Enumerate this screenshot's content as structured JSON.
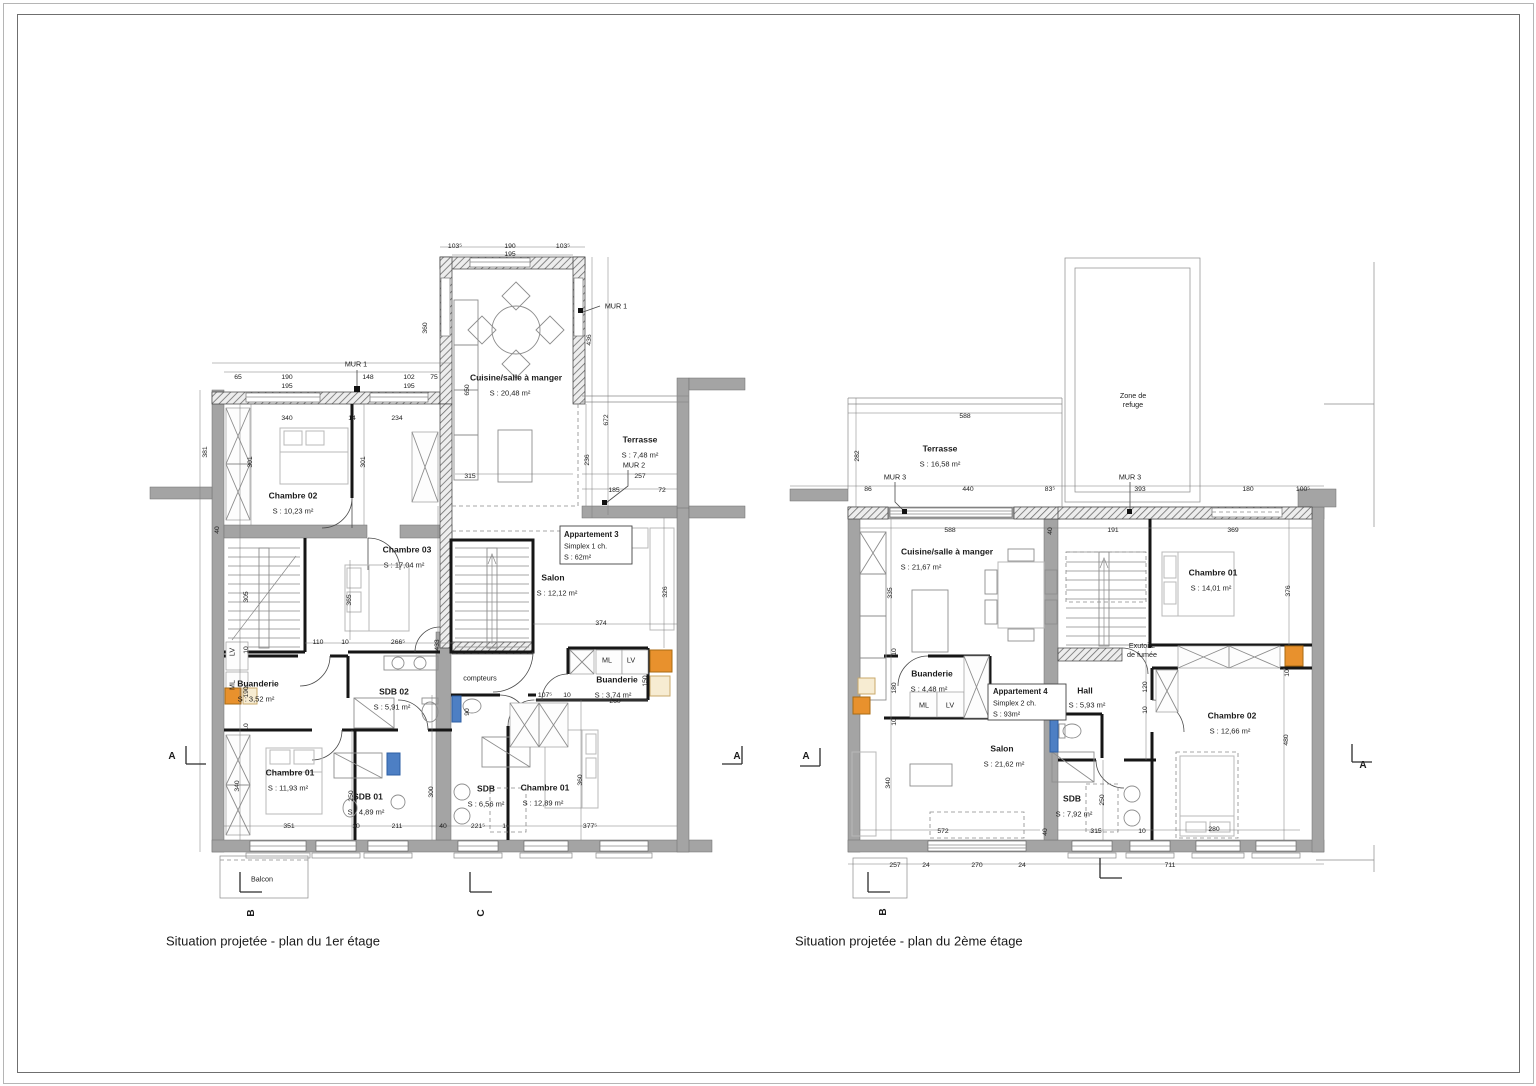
{
  "captions": {
    "plan1": "Situation projetée - plan du 1er étage",
    "plan2": "Situation projetée - plan du 2ème étage"
  },
  "colors": {
    "wall_gray": "#a4a4a4",
    "partition_black": "#161616",
    "accent_orange": "#e8912d",
    "accent_blue": "#4d7fc4",
    "accent_beige": "#f7ecd2"
  },
  "plan1": {
    "labels": [
      {
        "t": "Cuisine/salle à manger",
        "x": 516,
        "y": 378,
        "c": "rm"
      },
      {
        "t": "S : 20,48 m²",
        "x": 510,
        "y": 393,
        "c": "ar"
      },
      {
        "t": "Terrasse",
        "x": 640,
        "y": 440,
        "c": "rm"
      },
      {
        "t": "S : 7,48 m²",
        "x": 640,
        "y": 455,
        "c": "ar"
      },
      {
        "t": "Chambre 02",
        "x": 293,
        "y": 496,
        "c": "rm"
      },
      {
        "t": "S : 10,23 m²",
        "x": 293,
        "y": 511,
        "c": "ar"
      },
      {
        "t": "Chambre 03",
        "x": 407,
        "y": 550,
        "c": "rm"
      },
      {
        "t": "S : 17,04 m²",
        "x": 404,
        "y": 565,
        "c": "ar"
      },
      {
        "t": "Salon",
        "x": 553,
        "y": 578,
        "c": "rm"
      },
      {
        "t": "S : 12,12 m²",
        "x": 557,
        "y": 593,
        "c": "ar"
      },
      {
        "t": "Buanderie",
        "x": 258,
        "y": 684,
        "c": "rm"
      },
      {
        "t": "S : 3,52 m²",
        "x": 256,
        "y": 699,
        "c": "ar"
      },
      {
        "t": "SDB 02",
        "x": 394,
        "y": 692,
        "c": "rm"
      },
      {
        "t": "S : 5,91 m²",
        "x": 392,
        "y": 707,
        "c": "ar"
      },
      {
        "t": "Buanderie",
        "x": 617,
        "y": 680,
        "c": "rm"
      },
      {
        "t": "S : 3,74 m²",
        "x": 613,
        "y": 695,
        "c": "ar"
      },
      {
        "t": "Chambre 01",
        "x": 290,
        "y": 773,
        "c": "rm"
      },
      {
        "t": "S : 11,93 m²",
        "x": 288,
        "y": 788,
        "c": "ar"
      },
      {
        "t": "SDB 01",
        "x": 368,
        "y": 797,
        "c": "rm"
      },
      {
        "t": "S : 4,89 m²",
        "x": 366,
        "y": 812,
        "c": "ar"
      },
      {
        "t": "SDB",
        "x": 486,
        "y": 789,
        "c": "rm"
      },
      {
        "t": "S : 6,56 m²",
        "x": 486,
        "y": 804,
        "c": "ar"
      },
      {
        "t": "Chambre 01",
        "x": 545,
        "y": 788,
        "c": "rm"
      },
      {
        "t": "S : 12,89 m²",
        "x": 543,
        "y": 803,
        "c": "ar"
      },
      {
        "t": "Balcon",
        "x": 262,
        "y": 879,
        "c": "nt"
      },
      {
        "t": "compteurs",
        "x": 480,
        "y": 678,
        "c": "nt"
      },
      {
        "t": "Appartement 3",
        "x": 564,
        "y": 535,
        "c": "bxb"
      },
      {
        "t": "Simplex 1 ch.",
        "x": 564,
        "y": 546,
        "c": "bx"
      },
      {
        "t": "S : 62m²",
        "x": 564,
        "y": 557,
        "c": "bx"
      },
      {
        "t": "MUR 1",
        "x": 356,
        "y": 364,
        "c": "mur"
      },
      {
        "t": "MUR 1",
        "x": 616,
        "y": 306,
        "c": "mur"
      },
      {
        "t": "MUR 2",
        "x": 634,
        "y": 465,
        "c": "mur"
      },
      {
        "t": "103⁵",
        "x": 455,
        "y": 247,
        "c": "dim"
      },
      {
        "t": "190",
        "x": 510,
        "y": 247,
        "c": "dim"
      },
      {
        "t": "103⁵",
        "x": 563,
        "y": 247,
        "c": "dim"
      },
      {
        "t": "195",
        "x": 510,
        "y": 255,
        "c": "dim"
      },
      {
        "t": "65",
        "x": 238,
        "y": 378,
        "c": "dim"
      },
      {
        "t": "190",
        "x": 287,
        "y": 378,
        "c": "dim"
      },
      {
        "t": "148",
        "x": 368,
        "y": 378,
        "c": "dim"
      },
      {
        "t": "102",
        "x": 409,
        "y": 378,
        "c": "dim"
      },
      {
        "t": "75",
        "x": 434,
        "y": 378,
        "c": "dim"
      },
      {
        "t": "195",
        "x": 287,
        "y": 387,
        "c": "dim"
      },
      {
        "t": "195",
        "x": 409,
        "y": 387,
        "c": "dim"
      },
      {
        "t": "360",
        "x": 426,
        "y": 328,
        "c": "dim",
        "r": 1
      },
      {
        "t": "650",
        "x": 468,
        "y": 390,
        "c": "dim",
        "r": 1
      },
      {
        "t": "436",
        "x": 590,
        "y": 340,
        "c": "dim",
        "r": 1
      },
      {
        "t": "672",
        "x": 607,
        "y": 420,
        "c": "dim",
        "r": 1
      },
      {
        "t": "236",
        "x": 588,
        "y": 460,
        "c": "dim",
        "r": 1
      },
      {
        "t": "315",
        "x": 470,
        "y": 477,
        "c": "dim"
      },
      {
        "t": "257",
        "x": 640,
        "y": 477,
        "c": "dim"
      },
      {
        "t": "185",
        "x": 614,
        "y": 491,
        "c": "dim"
      },
      {
        "t": "72",
        "x": 662,
        "y": 491,
        "c": "dim"
      },
      {
        "t": "381",
        "x": 206,
        "y": 452,
        "c": "dim",
        "r": 1
      },
      {
        "t": "40",
        "x": 218,
        "y": 530,
        "c": "dim",
        "r": 1
      },
      {
        "t": "305",
        "x": 247,
        "y": 597,
        "c": "dim",
        "r": 1
      },
      {
        "t": "10",
        "x": 247,
        "y": 650,
        "c": "dim",
        "r": 1
      },
      {
        "t": "LV",
        "x": 232,
        "y": 652,
        "c": "nt",
        "r": 1
      },
      {
        "t": "ML",
        "x": 232,
        "y": 685,
        "c": "nt",
        "r": 1
      },
      {
        "t": "190",
        "x": 247,
        "y": 692,
        "c": "dim",
        "r": 1
      },
      {
        "t": "10",
        "x": 247,
        "y": 727,
        "c": "dim",
        "r": 1
      },
      {
        "t": "340",
        "x": 238,
        "y": 786,
        "c": "dim",
        "r": 1
      },
      {
        "t": "340",
        "x": 287,
        "y": 419,
        "c": "dim"
      },
      {
        "t": "14",
        "x": 352,
        "y": 419,
        "c": "dim"
      },
      {
        "t": "234",
        "x": 397,
        "y": 419,
        "c": "dim"
      },
      {
        "t": "301",
        "x": 251,
        "y": 462,
        "c": "dim",
        "r": 1
      },
      {
        "t": "301",
        "x": 364,
        "y": 462,
        "c": "dim",
        "r": 1
      },
      {
        "t": "365",
        "x": 350,
        "y": 600,
        "c": "dim",
        "r": 1
      },
      {
        "t": "110",
        "x": 318,
        "y": 643,
        "c": "dim"
      },
      {
        "t": "10",
        "x": 345,
        "y": 643,
        "c": "dim"
      },
      {
        "t": "266⁵",
        "x": 398,
        "y": 643,
        "c": "dim"
      },
      {
        "t": "433",
        "x": 438,
        "y": 645,
        "c": "dim",
        "r": 1
      },
      {
        "t": "374",
        "x": 601,
        "y": 624,
        "c": "dim"
      },
      {
        "t": "326",
        "x": 666,
        "y": 592,
        "c": "dim",
        "r": 1
      },
      {
        "t": "107⁵",
        "x": 545,
        "y": 696,
        "c": "dim"
      },
      {
        "t": "10",
        "x": 567,
        "y": 696,
        "c": "dim"
      },
      {
        "t": "260",
        "x": 615,
        "y": 702,
        "c": "dim"
      },
      {
        "t": "150",
        "x": 646,
        "y": 681,
        "c": "dim",
        "r": 1
      },
      {
        "t": "90",
        "x": 468,
        "y": 712,
        "c": "dim",
        "r": 1
      },
      {
        "t": "250",
        "x": 352,
        "y": 796,
        "c": "dim",
        "r": 1
      },
      {
        "t": "300",
        "x": 432,
        "y": 792,
        "c": "dim",
        "r": 1
      },
      {
        "t": "360",
        "x": 581,
        "y": 780,
        "c": "dim",
        "r": 1
      },
      {
        "t": "351",
        "x": 289,
        "y": 827,
        "c": "dim"
      },
      {
        "t": "10",
        "x": 356,
        "y": 827,
        "c": "dim"
      },
      {
        "t": "211",
        "x": 397,
        "y": 827,
        "c": "dim"
      },
      {
        "t": "40",
        "x": 443,
        "y": 827,
        "c": "dim"
      },
      {
        "t": "221⁵",
        "x": 478,
        "y": 827,
        "c": "dim"
      },
      {
        "t": "10",
        "x": 506,
        "y": 827,
        "c": "dim"
      },
      {
        "t": "377⁵",
        "x": 590,
        "y": 827,
        "c": "dim"
      },
      {
        "t": "ML",
        "x": 607,
        "y": 660,
        "c": "nt"
      },
      {
        "t": "LV",
        "x": 631,
        "y": 660,
        "c": "nt"
      },
      {
        "t": "A",
        "x": 172,
        "y": 757,
        "c": "sec"
      },
      {
        "t": "A",
        "x": 737,
        "y": 757,
        "c": "sec"
      },
      {
        "t": "B",
        "x": 252,
        "y": 913,
        "c": "sec",
        "r": 1
      },
      {
        "t": "C",
        "x": 482,
        "y": 913,
        "c": "sec",
        "r": 1
      }
    ]
  },
  "plan2": {
    "labels": [
      {
        "t": "Zone de\nrefuge",
        "x": 1133,
        "y": 400,
        "c": "nt"
      },
      {
        "t": "Terrasse",
        "x": 940,
        "y": 449,
        "c": "rm"
      },
      {
        "t": "S : 16,58 m²",
        "x": 940,
        "y": 464,
        "c": "ar"
      },
      {
        "t": "Cuisine/salle à manger",
        "x": 947,
        "y": 552,
        "c": "rm"
      },
      {
        "t": "S : 21,67 m²",
        "x": 921,
        "y": 567,
        "c": "ar"
      },
      {
        "t": "Chambre 01",
        "x": 1213,
        "y": 573,
        "c": "rm"
      },
      {
        "t": "S : 14,01 m²",
        "x": 1211,
        "y": 588,
        "c": "ar"
      },
      {
        "t": "Buanderie",
        "x": 932,
        "y": 674,
        "c": "rm"
      },
      {
        "t": "S : 4,48 m²",
        "x": 929,
        "y": 689,
        "c": "ar"
      },
      {
        "t": "Hall",
        "x": 1085,
        "y": 691,
        "c": "rm"
      },
      {
        "t": "S : 5,93 m²",
        "x": 1087,
        "y": 705,
        "c": "ar"
      },
      {
        "t": "Salon",
        "x": 1002,
        "y": 749,
        "c": "rm"
      },
      {
        "t": "S : 21,62 m²",
        "x": 1004,
        "y": 764,
        "c": "ar"
      },
      {
        "t": "SDB",
        "x": 1072,
        "y": 799,
        "c": "rm"
      },
      {
        "t": "S : 7,92 m²",
        "x": 1074,
        "y": 814,
        "c": "ar"
      },
      {
        "t": "Chambre 02",
        "x": 1232,
        "y": 716,
        "c": "rm"
      },
      {
        "t": "S : 12,66 m²",
        "x": 1230,
        "y": 731,
        "c": "ar"
      },
      {
        "t": "Exutoire\nde fumée",
        "x": 1142,
        "y": 650,
        "c": "nt"
      },
      {
        "t": "Appartement 4",
        "x": 993,
        "y": 692,
        "c": "bxb"
      },
      {
        "t": "Simplex 2 ch.",
        "x": 993,
        "y": 703,
        "c": "bx"
      },
      {
        "t": "S : 93m²",
        "x": 993,
        "y": 714,
        "c": "bx"
      },
      {
        "t": "ML",
        "x": 924,
        "y": 705,
        "c": "nt"
      },
      {
        "t": "LV",
        "x": 950,
        "y": 705,
        "c": "nt"
      },
      {
        "t": "MUR 3",
        "x": 895,
        "y": 477,
        "c": "mur"
      },
      {
        "t": "MUR 3",
        "x": 1130,
        "y": 477,
        "c": "mur"
      },
      {
        "t": "588",
        "x": 965,
        "y": 417,
        "c": "dim"
      },
      {
        "t": "282",
        "x": 858,
        "y": 456,
        "c": "dim",
        "r": 1
      },
      {
        "t": "86",
        "x": 868,
        "y": 490,
        "c": "dim"
      },
      {
        "t": "440",
        "x": 968,
        "y": 490,
        "c": "dim"
      },
      {
        "t": "83⁵",
        "x": 1050,
        "y": 490,
        "c": "dim"
      },
      {
        "t": "393",
        "x": 1140,
        "y": 490,
        "c": "dim"
      },
      {
        "t": "180",
        "x": 1248,
        "y": 490,
        "c": "dim"
      },
      {
        "t": "100⁵",
        "x": 1303,
        "y": 490,
        "c": "dim"
      },
      {
        "t": "588",
        "x": 950,
        "y": 531,
        "c": "dim"
      },
      {
        "t": "40",
        "x": 1051,
        "y": 531,
        "c": "dim",
        "r": 1
      },
      {
        "t": "191",
        "x": 1113,
        "y": 531,
        "c": "dim"
      },
      {
        "t": "369",
        "x": 1233,
        "y": 531,
        "c": "dim"
      },
      {
        "t": "335",
        "x": 891,
        "y": 593,
        "c": "dim",
        "r": 1
      },
      {
        "t": "10",
        "x": 895,
        "y": 652,
        "c": "dim",
        "r": 1
      },
      {
        "t": "180",
        "x": 895,
        "y": 688,
        "c": "dim",
        "r": 1
      },
      {
        "t": "10",
        "x": 895,
        "y": 722,
        "c": "dim",
        "r": 1
      },
      {
        "t": "340",
        "x": 889,
        "y": 783,
        "c": "dim",
        "r": 1
      },
      {
        "t": "376",
        "x": 1289,
        "y": 591,
        "c": "dim",
        "r": 1
      },
      {
        "t": "10",
        "x": 1288,
        "y": 673,
        "c": "dim",
        "r": 1
      },
      {
        "t": "480",
        "x": 1287,
        "y": 740,
        "c": "dim",
        "r": 1
      },
      {
        "t": "120",
        "x": 1146,
        "y": 687,
        "c": "dim",
        "r": 1
      },
      {
        "t": "10",
        "x": 1146,
        "y": 710,
        "c": "dim",
        "r": 1
      },
      {
        "t": "250",
        "x": 1103,
        "y": 800,
        "c": "dim",
        "r": 1
      },
      {
        "t": "572",
        "x": 943,
        "y": 832,
        "c": "dim"
      },
      {
        "t": "40",
        "x": 1046,
        "y": 832,
        "c": "dim",
        "r": 1
      },
      {
        "t": "315",
        "x": 1096,
        "y": 832,
        "c": "dim"
      },
      {
        "t": "10",
        "x": 1142,
        "y": 832,
        "c": "dim"
      },
      {
        "t": "280",
        "x": 1214,
        "y": 830,
        "c": "dim"
      },
      {
        "t": "257",
        "x": 895,
        "y": 866,
        "c": "dim"
      },
      {
        "t": "24",
        "x": 926,
        "y": 866,
        "c": "dim"
      },
      {
        "t": "270",
        "x": 977,
        "y": 866,
        "c": "dim"
      },
      {
        "t": "24",
        "x": 1022,
        "y": 866,
        "c": "dim"
      },
      {
        "t": "711",
        "x": 1170,
        "y": 866,
        "c": "dim"
      },
      {
        "t": "A",
        "x": 806,
        "y": 757,
        "c": "sec"
      },
      {
        "t": "A",
        "x": 1363,
        "y": 766,
        "c": "sec"
      },
      {
        "t": "B",
        "x": 884,
        "y": 912,
        "c": "sec",
        "r": 1
      }
    ]
  }
}
